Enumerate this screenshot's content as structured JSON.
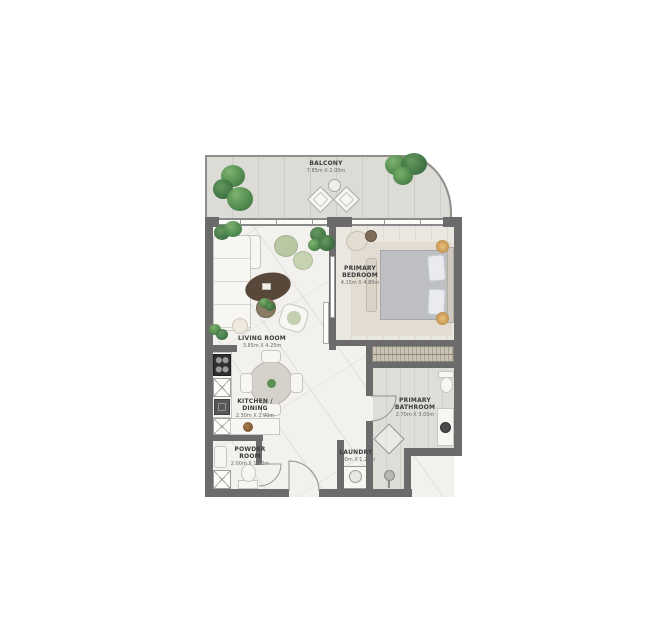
{
  "plan": {
    "rooms": [
      {
        "name": "BALCONY",
        "dims": "7.85m X 2.00m"
      },
      {
        "name": "LIVING ROOM",
        "dims": "3.85m X 4.25m"
      },
      {
        "name": "PRIMARY BEDROOM",
        "dims": "4.15m X 4.80m"
      },
      {
        "name": "KITCHEN / DINING",
        "dims": "2.30m X 2.90m"
      },
      {
        "name": "PRIMARY BATHROOM",
        "dims": "2.70m X 3.05m"
      },
      {
        "name": "POWDER ROOM",
        "dims": "2.00m X 1.50m"
      },
      {
        "name": "LAUNDRY",
        "dims": "0.90m X 1.20m"
      }
    ],
    "colors": {
      "wall": "#6b6b6b",
      "balcony_floor": "#dcdbd6",
      "interior_floor": "#f2f1ee",
      "bedroom_floor": "#eae6e0",
      "bathroom_floor": "#deddd8",
      "wardrobe": "#c9c3b5",
      "plant_green": "#4d8a4a",
      "pouf_sage": "#b9c7a3",
      "coffee_table_brown": "#584839",
      "bed_grey": "#bdbfc3",
      "lamp_gold": "#cda05c"
    }
  }
}
